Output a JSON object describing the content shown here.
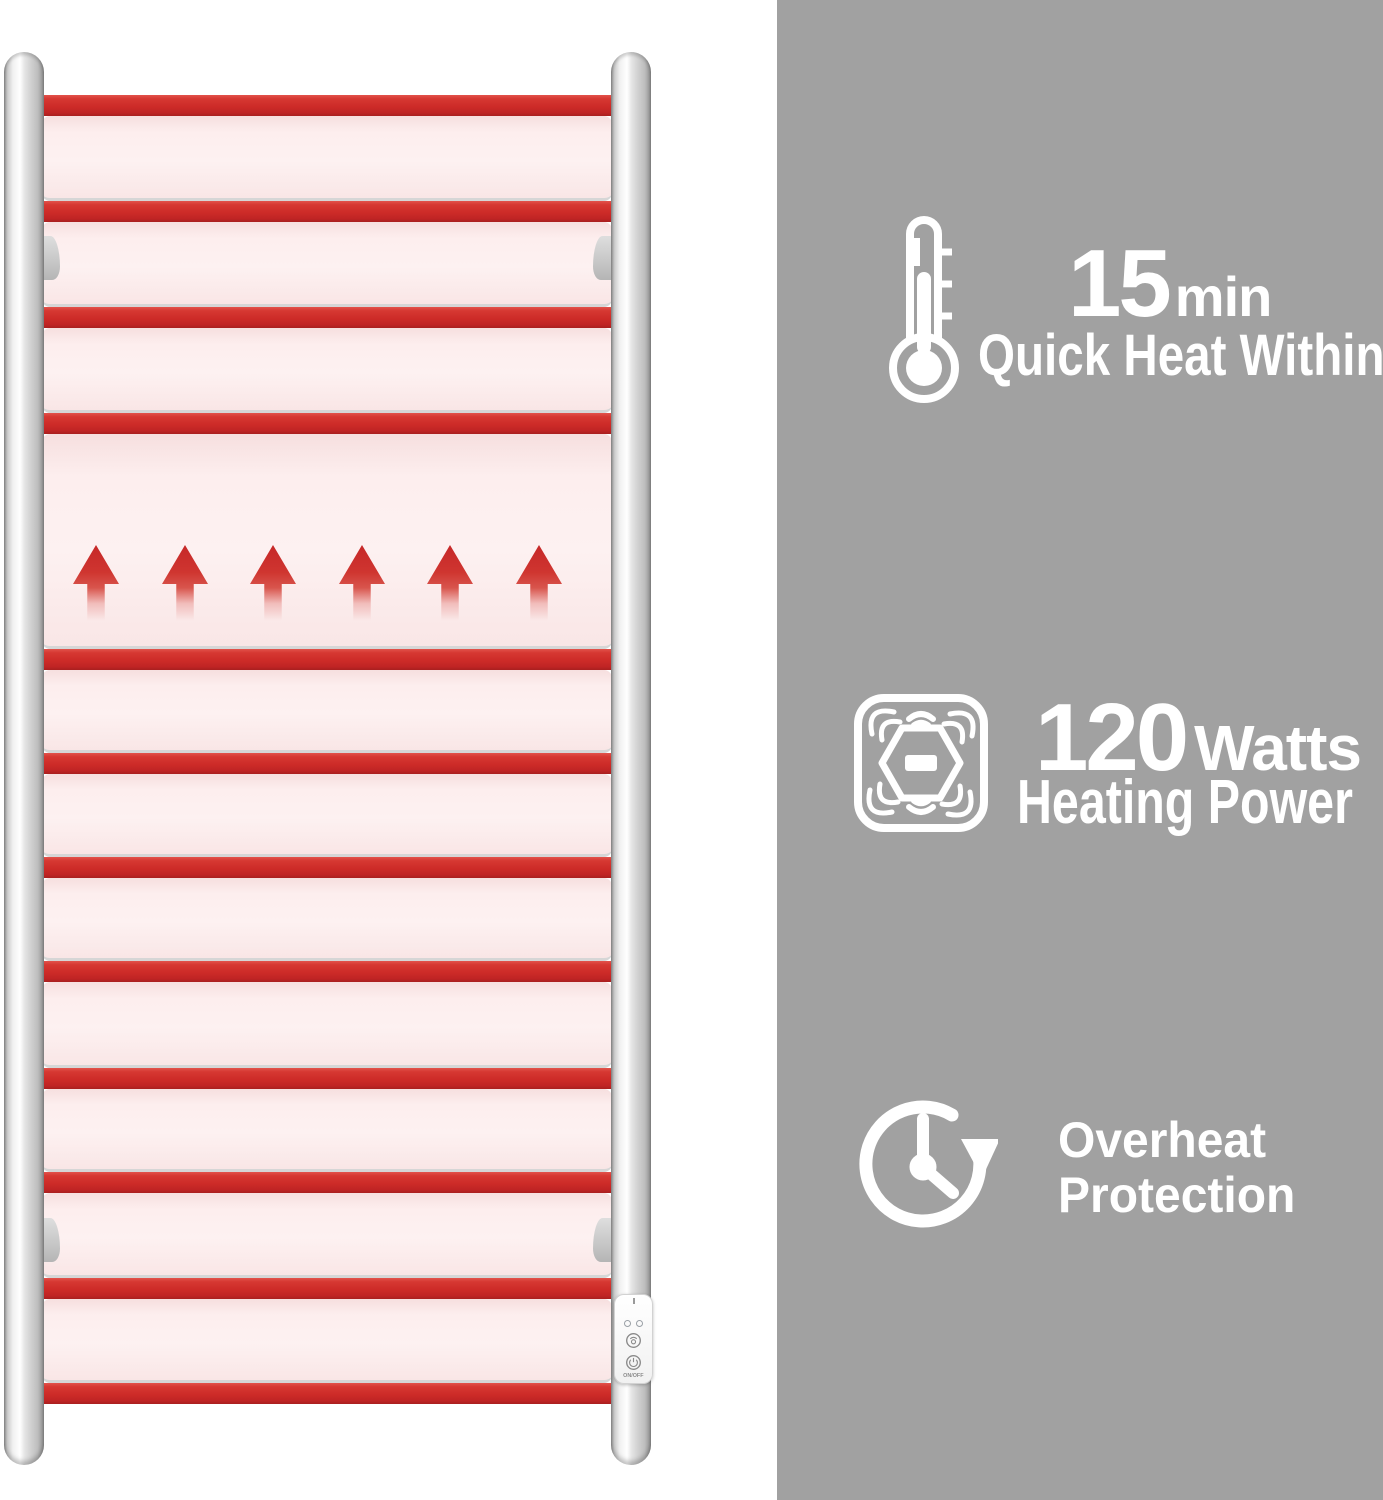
{
  "layout_colors": {
    "right_panel_bg": "#a1a1a1",
    "rack_red": "#cd2b28",
    "rack_pink": "#fdeeee",
    "chrome": "#d9d9d9",
    "text": "#ffffff"
  },
  "rack": {
    "rungs": 12,
    "heat_arrows": 6
  },
  "features": [
    {
      "icon": "thermometer-icon",
      "value": "15",
      "unit": "min",
      "label": "Quick Heat Within"
    },
    {
      "icon": "heat-sensor-icon",
      "value": "120",
      "unit": "Watts",
      "label": "Heating Power"
    },
    {
      "icon": "overheat-clock-icon",
      "label_line1": "Overheat",
      "label_line2": "Protection"
    }
  ],
  "control_panel": {
    "power_label": "ON/OFF"
  }
}
